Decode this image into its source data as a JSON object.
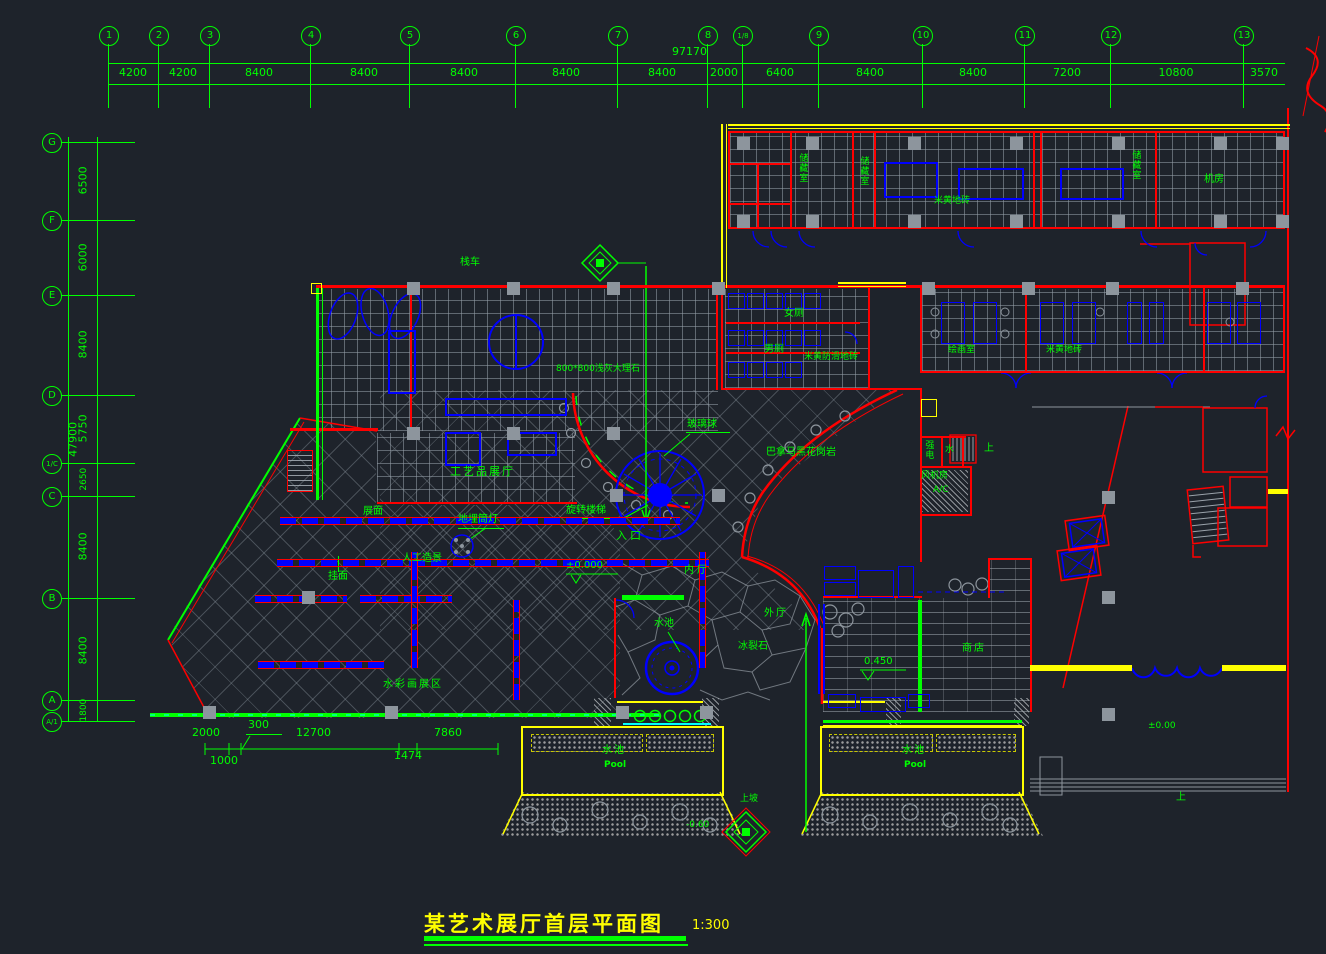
{
  "title": {
    "text": "某艺术展厅首层平面图",
    "scale": "1:300"
  },
  "grid_top": {
    "total": "97170",
    "bubbles": [
      "1",
      "2",
      "3",
      "4",
      "5",
      "6",
      "7",
      "8",
      "1/8",
      "9",
      "10",
      "11",
      "12",
      "13"
    ],
    "dims": [
      "4200",
      "4200",
      "8400",
      "8400",
      "8400",
      "8400",
      "8400",
      "2000",
      "6400",
      "8400",
      "8400",
      "7200",
      "10800",
      "3570"
    ]
  },
  "grid_left": {
    "total": "47900",
    "bubbles": [
      "G",
      "F",
      "E",
      "D",
      "1/C",
      "C",
      "B",
      "A",
      "A/1"
    ],
    "dims": [
      "6500",
      "6000",
      "8400",
      "5750",
      "2650",
      "8400",
      "8400",
      "1800"
    ]
  },
  "labels": {
    "zhanChe": "栈车",
    "marble": "800*800浅灰大理石",
    "gongYiPin": "工艺品展厅",
    "boLiQiu": "玻璃球",
    "xuanZhuanLouTi": "旋转楼梯",
    "ruKou": "入口",
    "level_zero": "±0.000",
    "neiTing": "内厅",
    "waiTing": "外厅",
    "bingLieShi": "冰裂石",
    "shuiChi": "水池",
    "poolEn": "Pool",
    "granite": "巴拿马黑花岗岩",
    "chuCangShi": "储藏室",
    "jiFang": "机房",
    "miHuangDiZhuan": "米黄地砖",
    "nvCe": "女厕",
    "nanCe": "男厕",
    "fangHuaZhuan": "米黄防滑地砖",
    "huiHuaShi": "绘画室",
    "qiangDian": "强电",
    "shui": "水",
    "fengJiFang": "风机房",
    "ac": "A/C",
    "shang": "上",
    "shangDian": "商店",
    "level_450": "0.450",
    "level_pm000": "±0.00",
    "level_neg060": "-0.60",
    "shangPo": "上坡",
    "diMaiTongDeng": "地埋筒灯",
    "renGongZaoJing": "人工造景",
    "guaMian": "挂面",
    "zhanMian": "展面",
    "shuiCaiHua": "水彩画展区"
  },
  "bottom_dims": [
    "2000",
    "300",
    "12700",
    "7860",
    "1000",
    "1474"
  ]
}
